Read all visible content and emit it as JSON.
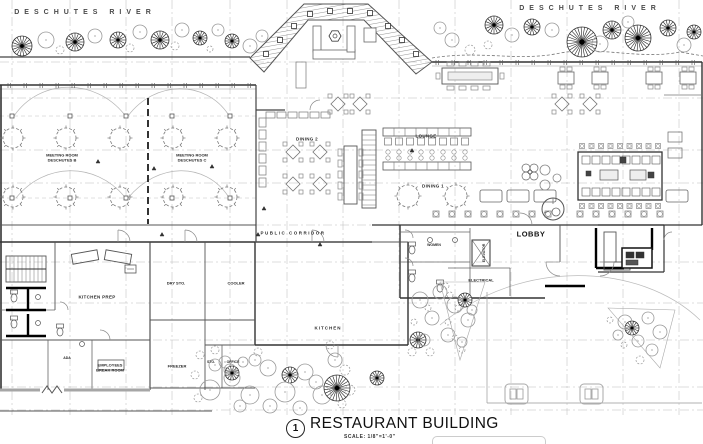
{
  "site": {
    "river_left": "DESCHUTES RIVER",
    "river_right": "DESCHUTES RIVER"
  },
  "rooms": {
    "meeting_room_b": {
      "line1": "MEETING ROOM",
      "line2": "DESCHUTES B"
    },
    "meeting_room_c": {
      "line1": "MEETING ROOM",
      "line2": "DESCHUTES C"
    },
    "dining_2": "DINING 2",
    "dining_1": "DINING 1",
    "lounge": "LOUNGE",
    "public_corridor": "PUBLIC CORRIDOR",
    "lobby": "LOBBY",
    "women": "WOMEN",
    "elevator": "ELEVATOR",
    "electrical": "ELECTRICAL",
    "kitchen": "KITCHEN",
    "kitchen_prep": "KITCHEN PREP",
    "dry_storage": "DRY STO.",
    "cooler": "COOLER",
    "freezer": "FREEZER",
    "employees_break_room": {
      "line1": "EMPLOYEES",
      "line2": "BREAK ROOM"
    },
    "ada": "ADA",
    "storage": "STO.",
    "office": "OFFICE"
  },
  "title_block": {
    "detail_number": "1",
    "title": "RESTAURANT BUILDING",
    "scale": "SCALE:   1/8\"=1'-0\""
  },
  "colors": {
    "paper": "#ffffff",
    "line_dark": "#2b2b2b",
    "line_mid": "#666666",
    "line_light": "#aaaaaa"
  }
}
